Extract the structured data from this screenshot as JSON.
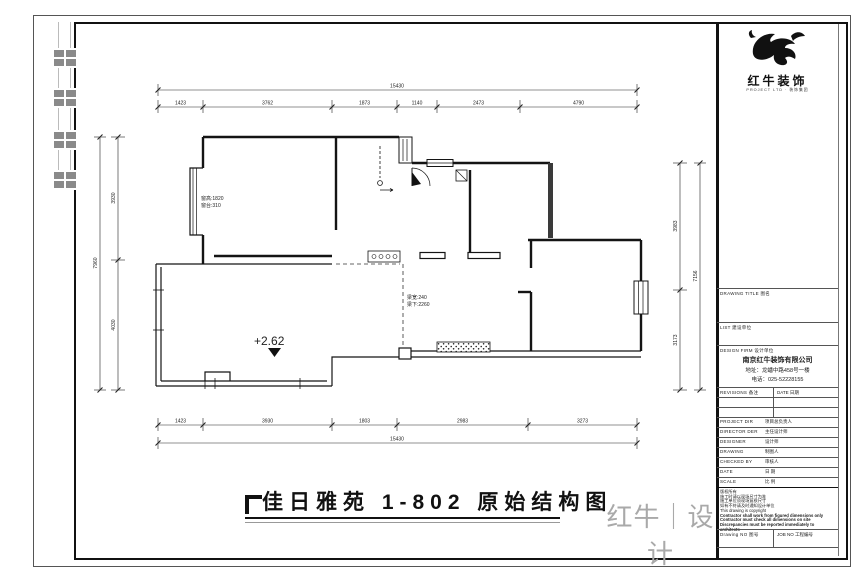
{
  "footer": {
    "title": "佳日雅苑 1-802 原始结构图",
    "brand": "红牛｜设计"
  },
  "titleblock": {
    "company_short": "红牛装饰",
    "logo_caption": "PROJECT LTD · 装饰集团",
    "section_drawing_title": "DRAWING TITLE 图名",
    "section_client": "LIST 建设单位",
    "section_design_firm": "DESIGN FIRM 设计单位",
    "company": "南京红牛装饰有限公司",
    "address": "地址：龙蟠中路458号一楼",
    "phone": "电话：025-52228155",
    "revisions_label": "REVISIONS 备注",
    "date_label": "DATE 日期",
    "personnel": [
      {
        "en": "PROJECT DIR",
        "zh": "项目总负责人"
      },
      {
        "en": "DIRECTOR DER",
        "zh": "主任设计师"
      },
      {
        "en": "DESIGNER",
        "zh": "设计师"
      },
      {
        "en": "DRAWING",
        "zh": "制图人"
      },
      {
        "en": "CHECKED BY",
        "zh": "审核人"
      },
      {
        "en": "DATE",
        "zh": "日 期"
      },
      {
        "en": "SCALE",
        "zh": "比 例"
      }
    ],
    "notes": [
      "版权所有",
      "施工时请以现场尺寸为准",
      "施工单位须现场复核尺寸",
      "如有不符请及时通知设计单位",
      "This drawing is copyright",
      "Contractor shall work from figured dimensions only",
      "Contractor must check all dimensions on site",
      "Discrepancies must be reported immediately to architects"
    ],
    "drawing_no_label": "Drawing NO 图号",
    "job_no_label": "JOB NO 工程编号"
  },
  "plan": {
    "level_mark": "+2.62",
    "window_height_note": "窗高:1820",
    "window_sill_note": "窗台:310",
    "beam_width_note": "梁宽:240",
    "beam_under_note": "梁下:2260",
    "dims": {
      "top_overall": "15430",
      "top": [
        "1423",
        "3762",
        "1873",
        "1140",
        "2473",
        "4790"
      ],
      "bottom": [
        "1423",
        "3930",
        "1803",
        "2983",
        "3273"
      ],
      "bottom_overall": "15430",
      "left_overall": "7960",
      "left": [
        "3930",
        "4030"
      ],
      "right": [
        "3983",
        "3173"
      ],
      "right_overall": "7156"
    }
  }
}
